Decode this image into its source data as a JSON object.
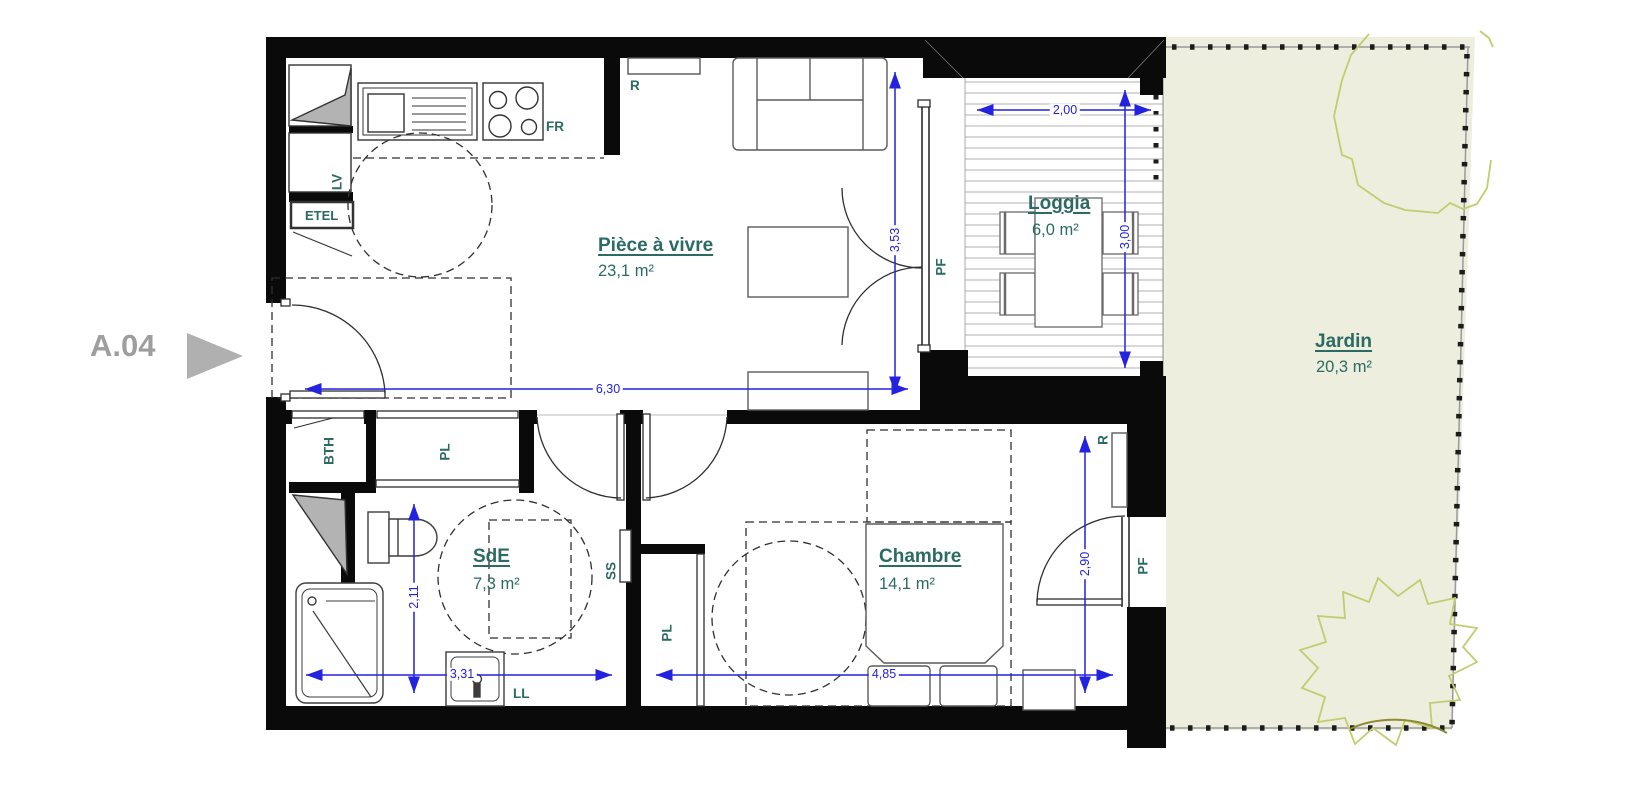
{
  "unit": {
    "id": "A.04"
  },
  "rooms": {
    "living": {
      "name": "Pièce à vivre",
      "area": "23,1 m²"
    },
    "loggia": {
      "name": "Loggia",
      "area": "6,0 m²"
    },
    "jardin": {
      "name": "Jardin",
      "area": "20,3 m²"
    },
    "sde": {
      "name": "SdE",
      "area": "7,3 m²"
    },
    "chambre": {
      "name": "Chambre",
      "area": "14,1 m²"
    }
  },
  "labels": {
    "fr": "FR",
    "r_kitchen": "R",
    "lv": "LV",
    "etel": "ETEL",
    "bth": "BTH",
    "pl_sde": "PL",
    "ss": "SS",
    "ll": "LL",
    "pf_living": "PF",
    "pl_chambre": "PL",
    "r_chambre": "R",
    "pf_chambre": "PF"
  },
  "dims": {
    "living_width": "6,30",
    "living_height": "3,53",
    "loggia_width": "2,00",
    "loggia_height": "3,00",
    "sde_height": "2,11",
    "sde_width": "3,31",
    "chambre_width": "4,85",
    "chambre_height": "2,90"
  },
  "colors": {
    "wall": "#0a0a0a",
    "label_teal": "#2b6b63",
    "dimension_blue": "#2222e0",
    "garden_fill": "#edeedd",
    "bush_green": "#c3cc70",
    "bush_dark": "#8f8a33",
    "marker_gray": "#9e9e9e",
    "duct_gray": "#b3b3b3"
  }
}
